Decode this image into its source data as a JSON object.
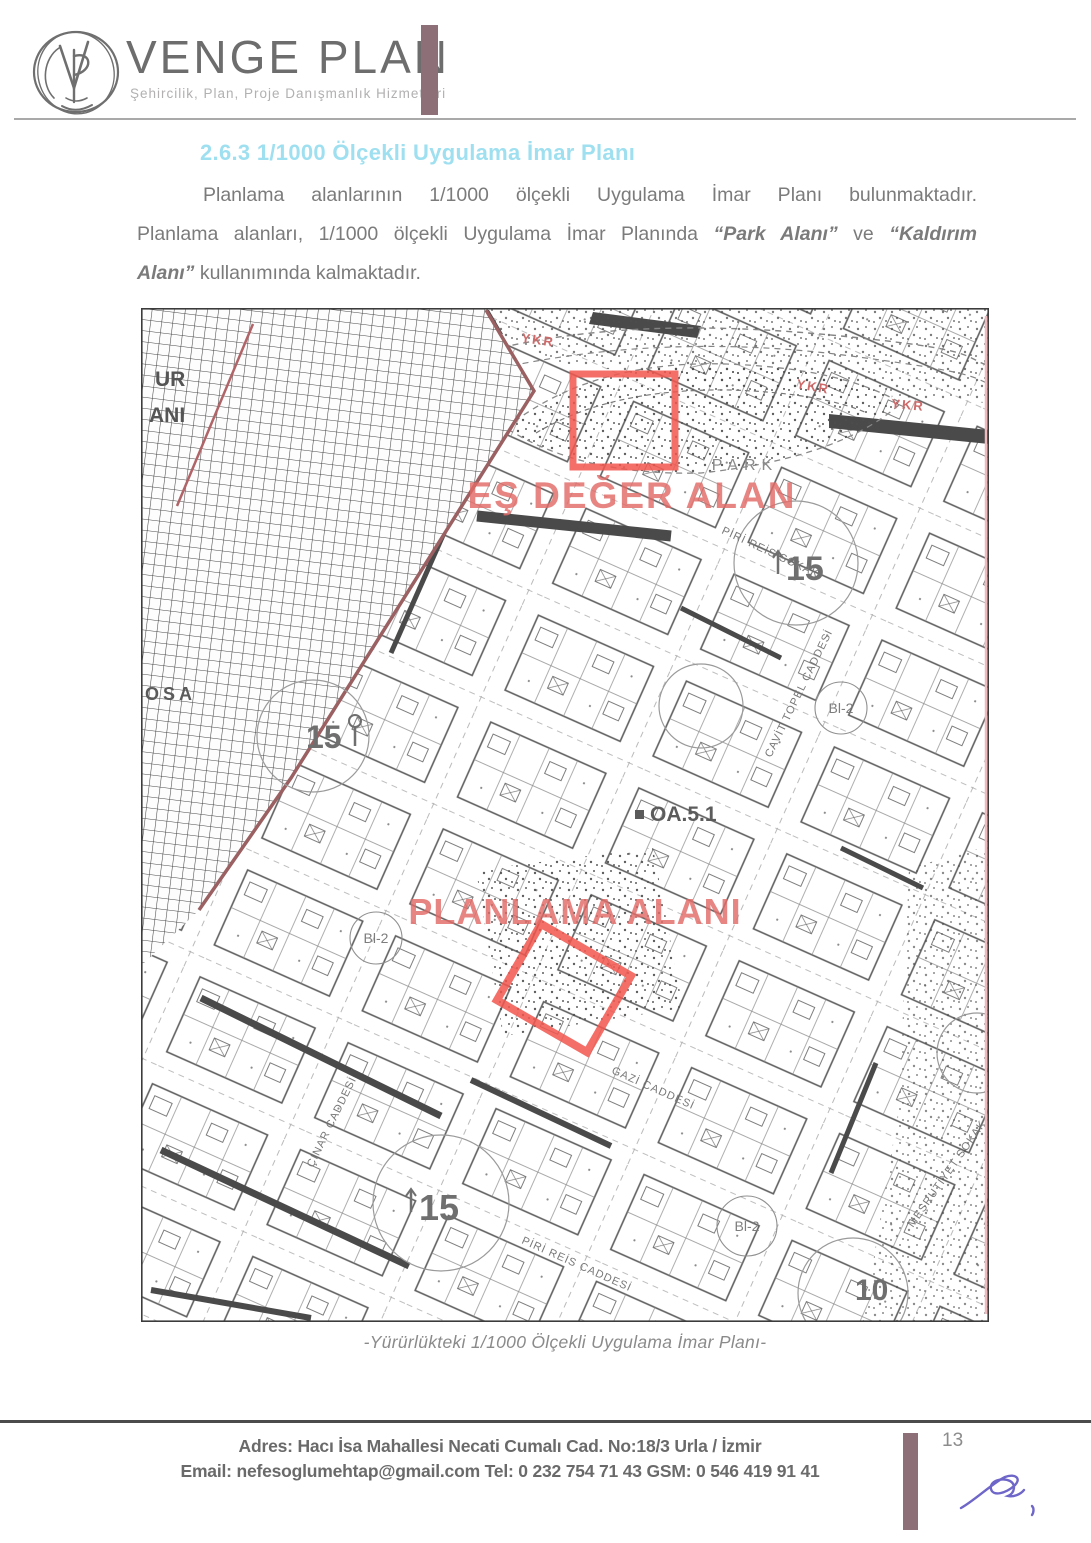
{
  "header": {
    "brand": "VENGE PLAN",
    "tagline": "Şehircilik, Plan, Proje Danışmanlık Hizmetleri",
    "monogram": "VP",
    "accent_color": "#8d6f77"
  },
  "content": {
    "heading": "2.6.3 1/1000 Ölçekli Uygulama İmar Planı",
    "heading_color": "#9edff0",
    "p_line1": "Planlama alanlarının 1/1000 ölçekli Uygulama İmar Planı bulunmaktadır.",
    "p_line2_a": "Planlama alanları, 1/1000 ölçekli Uygulama İmar Planında ",
    "p_line2_b": "“Park Alanı”",
    "p_line2_c": " ve ",
    "p_line2_d": "“Kaldırım",
    "p_line3_a": "Alanı”",
    "p_line3_b": " kullanımında kalmaktadır."
  },
  "map": {
    "caption": "-Yürürlükteki 1/1000 Ölçekli Uygulama İmar Planı-",
    "highlight_color": "#f2564e",
    "annotations": {
      "equivalent_area": "EŞ DEĞER ALAN",
      "planning_area": "PLANLAMA ALANI",
      "park": "PARK",
      "zone_code": "OA.5.1",
      "ykr": "YKR",
      "block_15": "15",
      "block_10": "10",
      "bl2": "Bl-2",
      "fragment_ur": "UR",
      "fragment_ani": "ANI",
      "fragment_osa": "OSA"
    },
    "streets": [
      "PİRİ REİS SOKAK",
      "CAVİT TOPEL CADDESİ",
      "GAZİ CADDESİ",
      "MEŞRUTİYET SOKAK",
      "ÇINAR CADDESİ",
      "PİRİ REİS CADDESİ"
    ]
  },
  "footer": {
    "address": "Adres: Hacı İsa Mahallesi Necati Cumalı  Cad. No:18/3  Urla / İzmir",
    "contact": "Email: nefesoglumehtap@gmail.com  Tel: 0 232 754 71 43   GSM: 0 546 419 91 41",
    "page_number": "13",
    "signature_color": "#6e66c8"
  }
}
